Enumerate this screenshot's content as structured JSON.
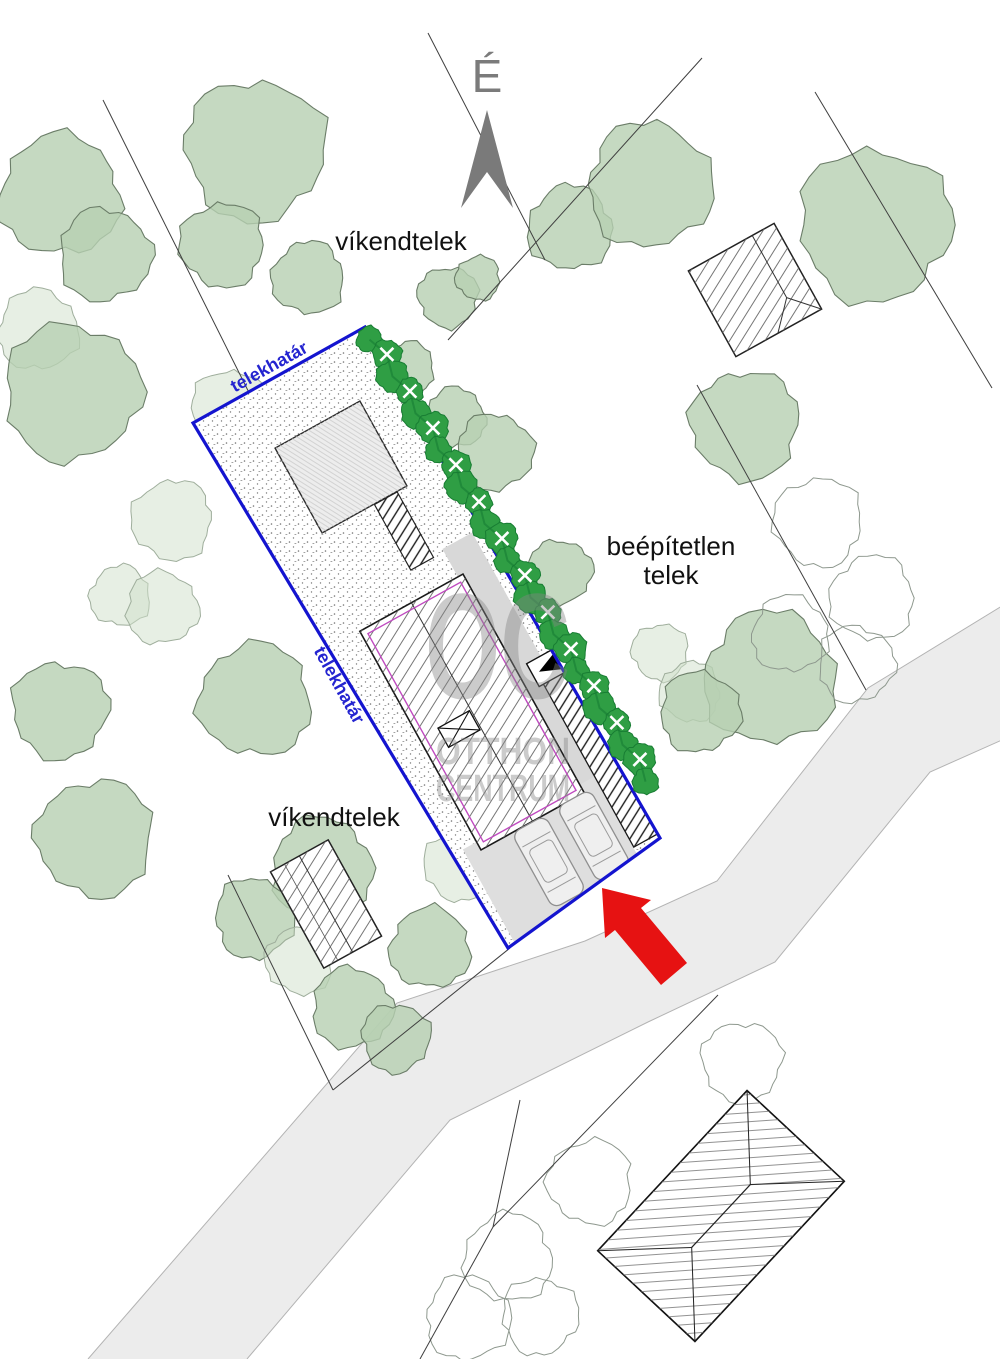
{
  "labels": {
    "north": "É",
    "weekend_plot_top": "víkendtelek",
    "weekend_plot_bottom": "víkendtelek",
    "vacant_plot_line1": "beépítetlen",
    "vacant_plot_line2": "telek",
    "boundary_top": "telekhatár",
    "boundary_left": "telekhatár"
  },
  "watermark": {
    "logo": "OC",
    "line1": "OTTHON",
    "line2": "CENTRUM"
  },
  "icons": {
    "north_arrow": "north-arrow",
    "entrance_arrow": "red-entrance-arrow",
    "house_entrance_marker": "black-triangle"
  },
  "colors": {
    "boundary_blue": "#1414cf",
    "boundary_text_blue": "#2424d0",
    "hedge_green": "#2f9e44",
    "hedge_dark": "#187d33",
    "tree_green": "#b7cfb1",
    "tree_light": "#cfe0ca",
    "road_gray": "#ececec",
    "driveway_gray": "#dedede",
    "deck_gray": "#d8d8d8",
    "arrow_red": "#e61212",
    "house_magenta": "#c04ac0",
    "north_gray": "#7a7a7a",
    "watermark_gray": "#868686"
  }
}
